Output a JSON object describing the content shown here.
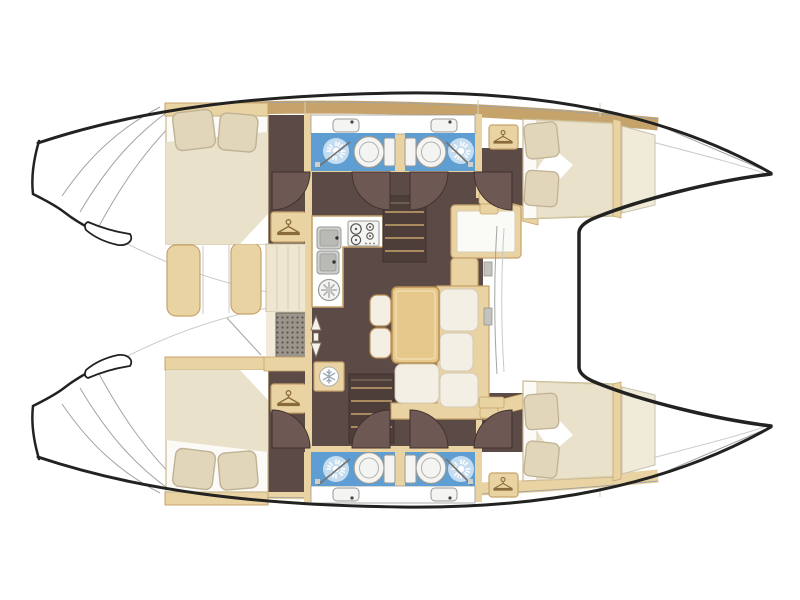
{
  "palette": {
    "page-bg": "#ffffff",
    "ink": "#222220",
    "line": "#a3a3a1",
    "tan": "#ead3a2",
    "tan-border": "#c6a36b",
    "tan-dark": "#8a6b3c",
    "wood": "#e6c78c",
    "wood-border": "#ba9054",
    "floor": "#5c4a46",
    "floor-dark": "#4e3e3a",
    "door": "#6e5853",
    "cream": "#efe6d1",
    "mattress": "#fbfaf6",
    "duvet": "#eae1cb",
    "pillow": "#e2d6ba",
    "blue": "#5e9ed2",
    "blue-pale": "#d7e8f6",
    "fixture": "#f4f4f2",
    "fixture-border": "#999996",
    "grate": "#9b958c",
    "grate-dot": "#5a554e",
    "glyph": "#98a4b8"
  },
  "diagram": {
    "label": "Catamaran sailboat interior floor plan, top-down view, bow pointing right",
    "hulls": {
      "port": "top",
      "starboard": "bottom"
    },
    "counts": {
      "cabins": 4,
      "heads": 4,
      "double_berths": 4,
      "wardrobes": 4
    },
    "rooms": [
      {
        "id": "aft-cabin-port",
        "features": [
          "double-berth",
          "2-pillows",
          "wardrobe-hanger"
        ]
      },
      {
        "id": "aft-cabin-starboard",
        "features": [
          "double-berth",
          "2-pillows",
          "wardrobe-hanger"
        ]
      },
      {
        "id": "forward-cabin-port",
        "features": [
          "double-berth",
          "2-pillows",
          "wardrobe-hanger",
          "entry-steps",
          "forepeak-locker"
        ]
      },
      {
        "id": "forward-cabin-starboard",
        "features": [
          "double-berth",
          "2-pillows",
          "wardrobe-hanger",
          "entry-steps",
          "forepeak-locker"
        ]
      },
      {
        "id": "head-port-aft",
        "features": [
          "toilet",
          "shower-sunburst",
          "washbasin",
          "shower-door"
        ]
      },
      {
        "id": "head-port-forward",
        "features": [
          "toilet",
          "shower-sunburst",
          "washbasin",
          "shower-door"
        ]
      },
      {
        "id": "head-starboard-aft",
        "features": [
          "toilet",
          "shower-sunburst",
          "washbasin",
          "shower-door"
        ]
      },
      {
        "id": "head-starboard-forward",
        "features": [
          "toilet",
          "shower-sunburst",
          "washbasin",
          "shower-door"
        ]
      },
      {
        "id": "galley",
        "features": [
          "double-sink",
          "four-burner-stove",
          "round-hob",
          "refrigerator-snowflake"
        ]
      },
      {
        "id": "salon",
        "features": [
          "dining-table",
          "l-shaped-sofa",
          "2-stools",
          "forward-nav-seat"
        ]
      },
      {
        "id": "companionways",
        "features": [
          "port-stairs",
          "starboard-stairs",
          "up-down-arrows",
          "floor-grate"
        ]
      },
      {
        "id": "exterior",
        "features": [
          "stern-steps-port",
          "stern-steps-starboard",
          "aft-cockpit-benches",
          "side-decks",
          "forward-crossbeam",
          "bow-foredeck"
        ]
      }
    ],
    "icons": [
      "hanger-icon",
      "snowflake-icon",
      "shower-sunburst-icon",
      "up-down-arrow-icon"
    ],
    "door_swings": 8
  }
}
